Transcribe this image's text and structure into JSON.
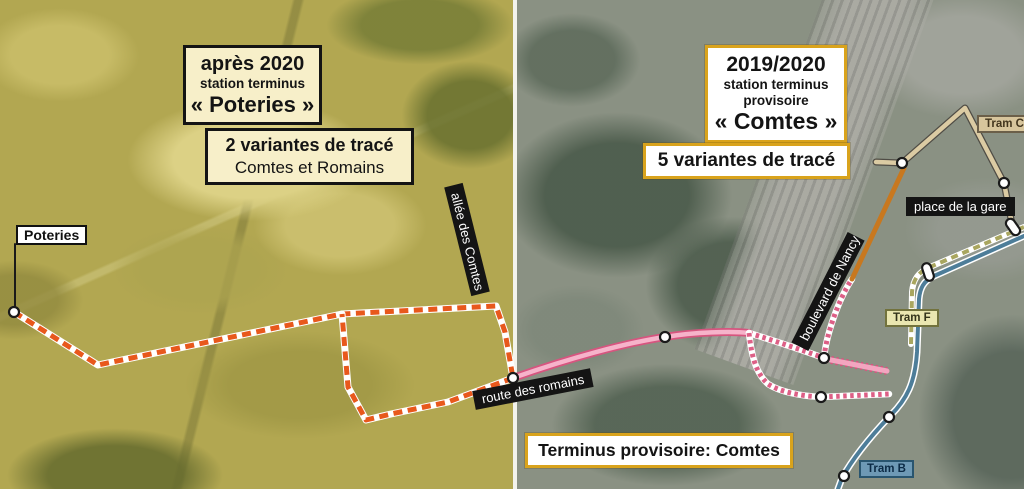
{
  "left_panel": {
    "title_box": {
      "line1": "après 2020",
      "line2": "station terminus",
      "line3": "« Poteries »"
    },
    "variants_box": {
      "line1": "2 variantes de tracé",
      "line2": "Comtes et Romains"
    },
    "poteries_label": "Poteries",
    "allee_comtes_label": "allée des Comtes",
    "route_romains_label": "route des romains"
  },
  "right_panel": {
    "title_box": {
      "line1": "2019/2020",
      "line2": "station terminus",
      "line3": "provisoire",
      "line4": "« Comtes »"
    },
    "variants_box": {
      "line1": "5 variantes de tracé"
    },
    "terminus_box": "Terminus provisoire: Comtes",
    "place_gare_label": "place de la gare",
    "boulevard_nancy_label": "boulevard de Nancy",
    "tram_c_label": "Tram C",
    "tram_f_label": "Tram F",
    "tram_b_label": "Tram B"
  },
  "colors": {
    "left_box_bg": "#f7efc9",
    "left_box_border": "#141414",
    "right_box_bg": "#ffffff",
    "right_box_border": "#d9a31c",
    "street_label_bg": "#141414",
    "street_label_text": "#ffffff",
    "orange_dash_variant": "#e8581c",
    "pink_route_fill": "#f6b3ca",
    "pink_route_edge": "#d6557f",
    "orange_boulevard": "#c8781f",
    "tram_c_tan": "#dbcba3",
    "tram_f_olive": "#a9a65f",
    "tram_b_blue": "#4d7d99"
  },
  "overlay": {
    "routes": [
      {
        "name": "poteries-leader-line",
        "d": "M15,244 L15,310",
        "layers": [
          {
            "color": "#1a1a1a",
            "width": 2
          }
        ]
      },
      {
        "name": "route-variant-poteries-approach",
        "d": "M14,312 L98,365 L342,314 L496,306 L505,332 L513,378",
        "layers": [
          {
            "color": "#ffffff",
            "width": 7
          },
          {
            "color": "#e8581c",
            "width": 5,
            "dash": "9 5.5"
          }
        ]
      },
      {
        "name": "route-variant-loop-south",
        "d": "M513,378 L448,402 L391,414 L366,420 L348,387 L342,314",
        "layers": [
          {
            "color": "#ffffff",
            "width": 7
          },
          {
            "color": "#e8581c",
            "width": 5,
            "dash": "9 5.5"
          }
        ]
      },
      {
        "name": "route-pink-main",
        "d": "M513,378 C570,358 625,343 665,337 C695,332 732,331 749,333",
        "layers": [
          {
            "color": "#d6557f",
            "width": 8
          },
          {
            "color": "#f6b3ca",
            "width": 4.5
          }
        ]
      },
      {
        "name": "route-checker-upper",
        "d": "M749,333 C775,341 802,350 824,358",
        "layers": [
          {
            "color": "#ffffff",
            "width": 6.5
          },
          {
            "color": "#dd5f86",
            "width": 5,
            "dash": "3.5 3.5"
          }
        ]
      },
      {
        "name": "route-checker-boulevard",
        "d": "M824,358 C826,336 838,300 852,279",
        "layers": [
          {
            "color": "#ffffff",
            "width": 6.5
          },
          {
            "color": "#dd5f86",
            "width": 5,
            "dash": "3.5 3.5"
          }
        ]
      },
      {
        "name": "route-checker-lower",
        "d": "M749,333 C752,360 757,374 768,384 C780,392 801,396 821,397 L889,394",
        "layers": [
          {
            "color": "#ffffff",
            "width": 6.5
          },
          {
            "color": "#dd5f86",
            "width": 5,
            "dash": "3.5 3.5"
          }
        ]
      },
      {
        "name": "route-pink-bar",
        "d": "M826,359 L887,371",
        "layers": [
          {
            "color": "#d6557f",
            "width": 8,
            "dash": "2.5 2.5"
          },
          {
            "color": "#f3a5c0",
            "width": 5
          }
        ]
      },
      {
        "name": "route-orange-boulevard",
        "d": "M852,279 L904,168",
        "layers": [
          {
            "color": "#c8781f",
            "width": 5
          }
        ]
      },
      {
        "name": "route-tram-c",
        "d": "M876,162 L902,163 L965,108 L1004,183 L1012,224",
        "layers": [
          {
            "color": "#4f4c45",
            "width": 7
          },
          {
            "color": "#dbcba3",
            "width": 4.5
          }
        ]
      },
      {
        "name": "route-tram-f",
        "d": "M1024,227 L930,267 C918,272 913,280 912,292 L911,344",
        "layers": [
          {
            "color": "#ffffff",
            "width": 6
          },
          {
            "color": "#a9a65f",
            "width": 4,
            "dash": "7 5"
          }
        ]
      },
      {
        "name": "route-tram-b",
        "d": "M1024,236 L934,276 C923,281 920,289 919,299 L917,352 C915,383 907,399 890,416 C871,436 853,458 842,478 L838,489",
        "layers": [
          {
            "color": "#ffffff",
            "width": 7
          },
          {
            "color": "#4d7d99",
            "width": 4
          }
        ]
      }
    ],
    "dots": [
      {
        "x": 14,
        "y": 312
      },
      {
        "x": 513,
        "y": 378
      },
      {
        "x": 665,
        "y": 337
      },
      {
        "x": 824,
        "y": 358
      },
      {
        "x": 821,
        "y": 397
      },
      {
        "x": 902,
        "y": 163
      },
      {
        "x": 1004,
        "y": 183
      },
      {
        "x": 889,
        "y": 417
      },
      {
        "x": 844,
        "y": 476
      }
    ],
    "ovals": [
      {
        "x": 1013,
        "y": 227,
        "rot": 55
      },
      {
        "x": 928,
        "y": 272,
        "rot": 72
      }
    ]
  }
}
